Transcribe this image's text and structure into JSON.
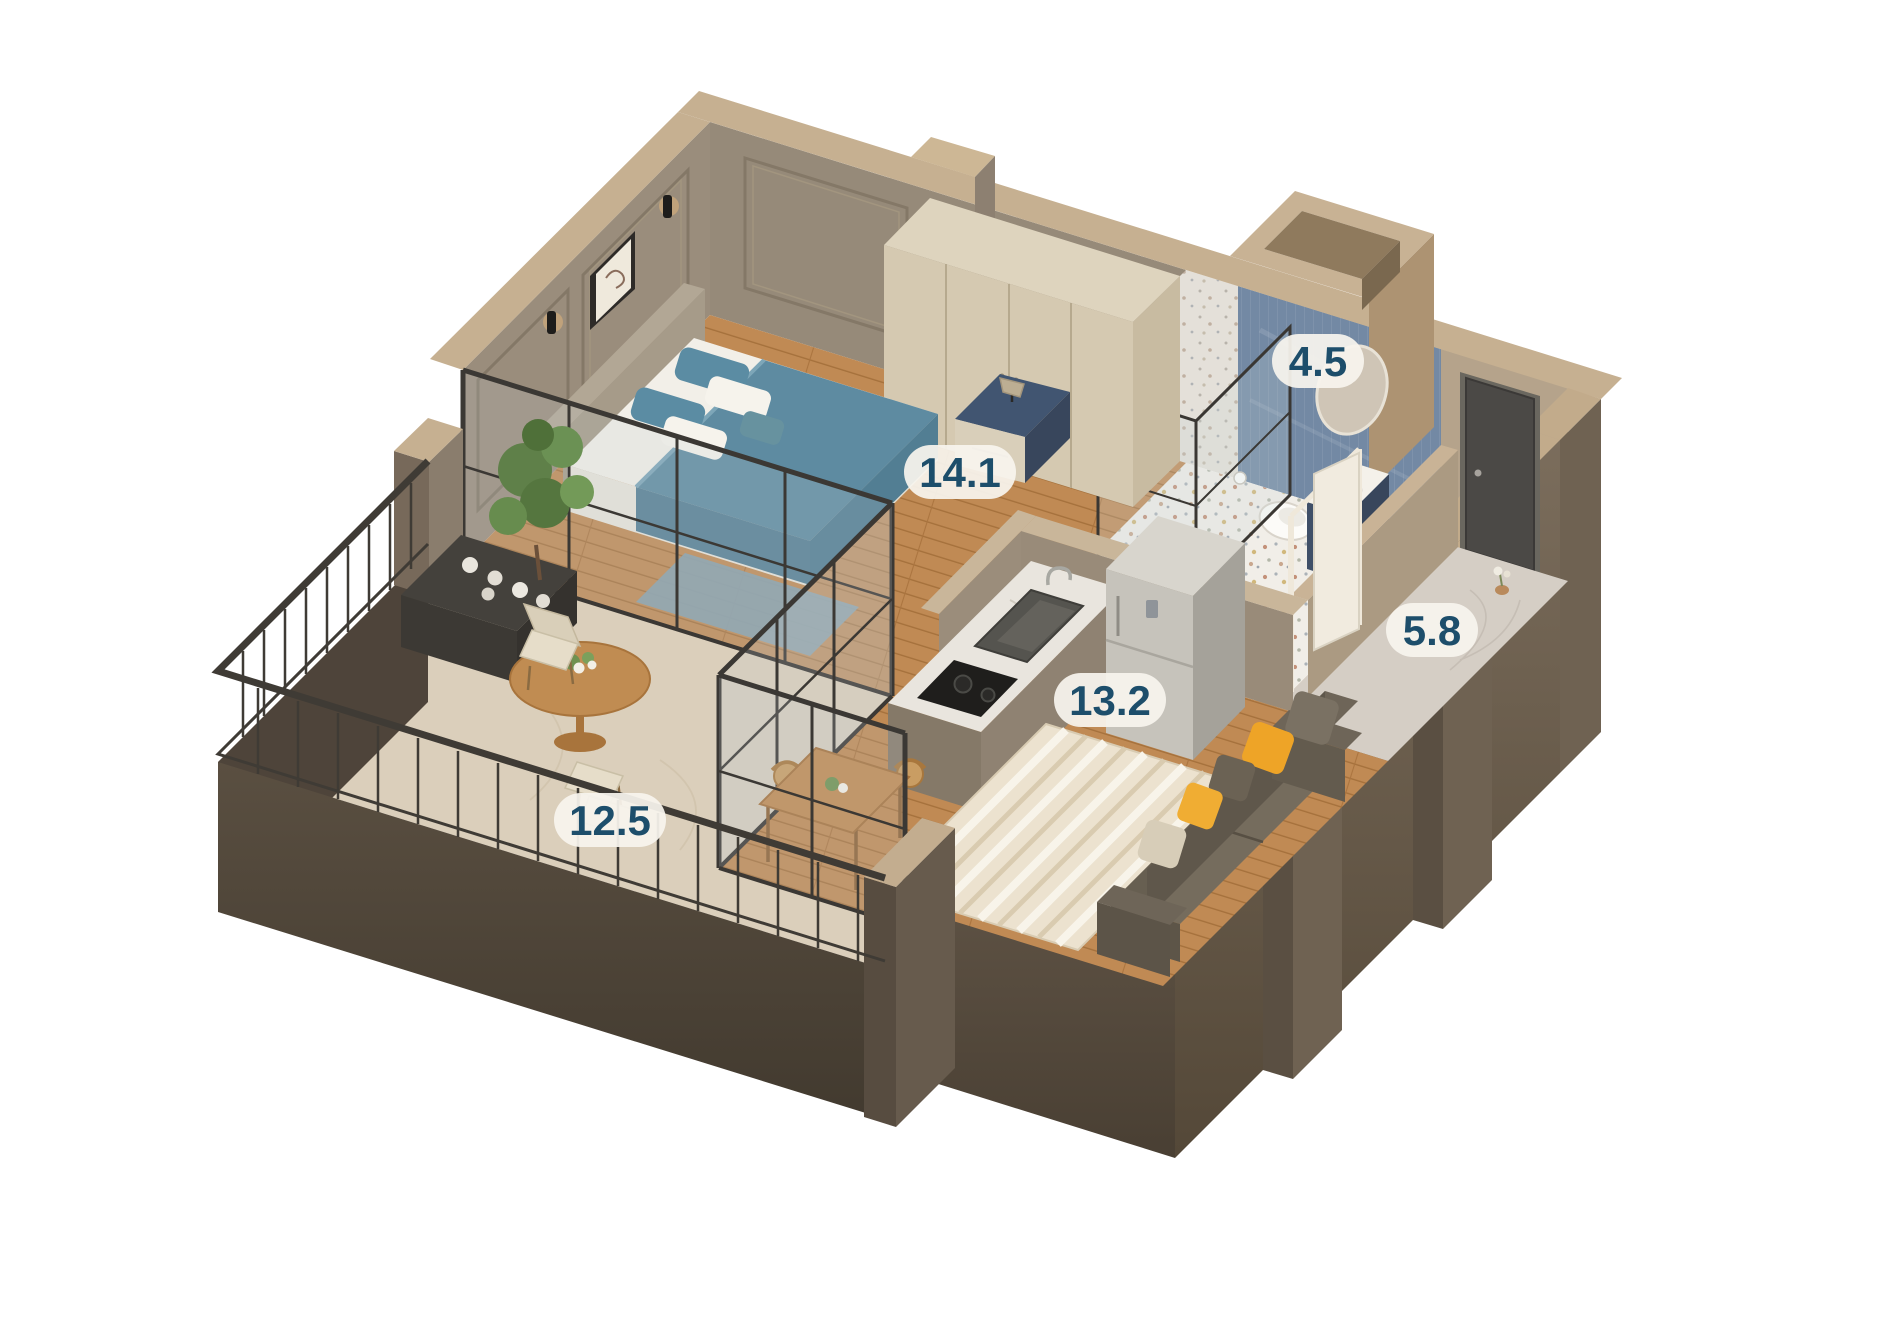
{
  "scene": {
    "background": "#ffffff",
    "type": "isometric-3d-floor-plan"
  },
  "palette": {
    "label_text": "#1d4e6b",
    "label_background": "#f7f4ee",
    "wall_top_beige": "#c6b091",
    "wall_outer_dark": "#584c3f",
    "wood_floor": "#c08a54",
    "stone_floor": "#dbcfbb",
    "bathroom_tile_blue": "#7389a4",
    "sofa_gray": "#6e6557",
    "pillow_yellow": "#eea427",
    "bed_teal": "#5e8ba1"
  },
  "rooms": [
    {
      "id": "bedroom",
      "area": "14.1"
    },
    {
      "id": "bathroom",
      "area": "4.5"
    },
    {
      "id": "hallway",
      "area": "5.8"
    },
    {
      "id": "kitchen-living",
      "area": "13.2"
    },
    {
      "id": "balcony",
      "area": "12.5"
    }
  ]
}
